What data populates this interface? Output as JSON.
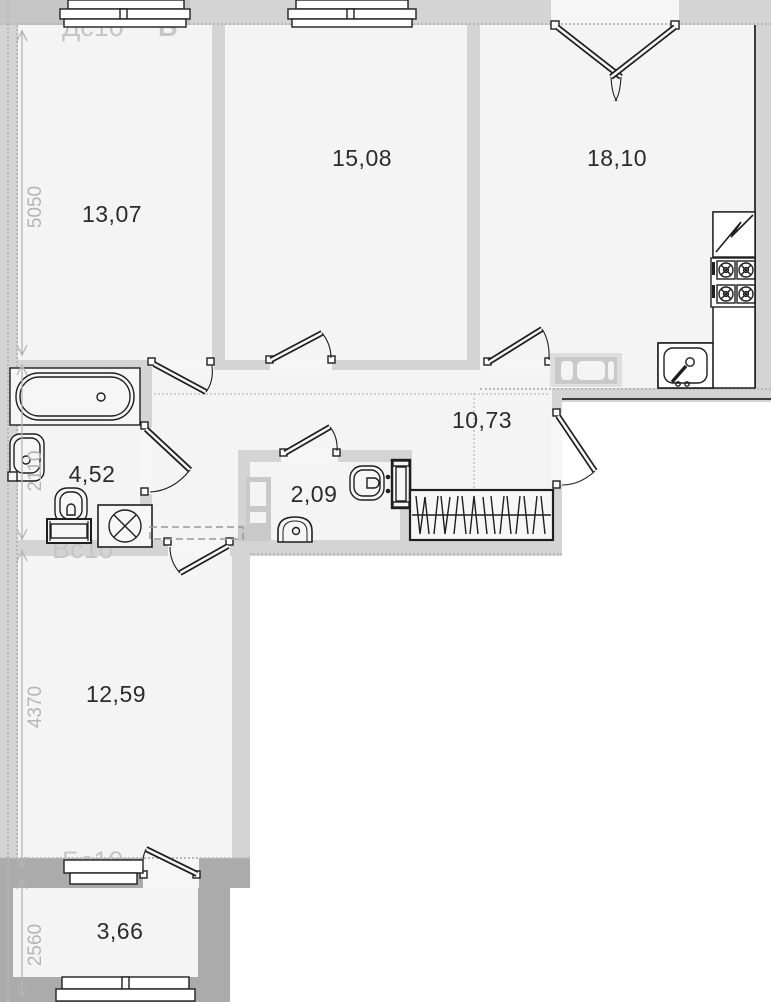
{
  "title": "apartment-floor-plan",
  "rooms": {
    "room1": {
      "name": "bedroom-top-left",
      "area": "13,07"
    },
    "room2": {
      "name": "bedroom-top-mid",
      "area": "15,08"
    },
    "kitchen": {
      "name": "kitchen",
      "area": "18,10"
    },
    "hallway": {
      "name": "hallway",
      "area": "10,73"
    },
    "bathroom": {
      "name": "bathroom",
      "area": "4,52"
    },
    "wc": {
      "name": "wc",
      "area": "2,09"
    },
    "room3": {
      "name": "bedroom-bottom",
      "area": "12,59"
    },
    "balcony": {
      "name": "balcony",
      "area": "3,66"
    }
  },
  "dimensions": {
    "left_top": "5050",
    "left_bath": "2110",
    "left_room3": "4370",
    "left_balcony": "2560"
  },
  "marks": {
    "corner": "Кс",
    "window_top": "Дс10",
    "section": "Б",
    "bath": "Гс10",
    "vent": "Вс10",
    "balcony": "Бс10"
  },
  "colors": {
    "wall": "#d4d4d4",
    "wall2": "#c6c6c6",
    "wall_dark": "#ababab",
    "room": "#f4f4f4",
    "line": "#1f1f1f",
    "mark": "#c6c6c6",
    "dim": "#b5b5b5",
    "area": "#2b2b2b"
  },
  "fixtures": [
    "bathtub",
    "washbasin",
    "toilet",
    "washing-machine",
    "wc-toilet",
    "wc-washbasin",
    "vent-shaft",
    "wardrobe",
    "fridge",
    "stove",
    "kitchen-sink",
    "radiator"
  ]
}
